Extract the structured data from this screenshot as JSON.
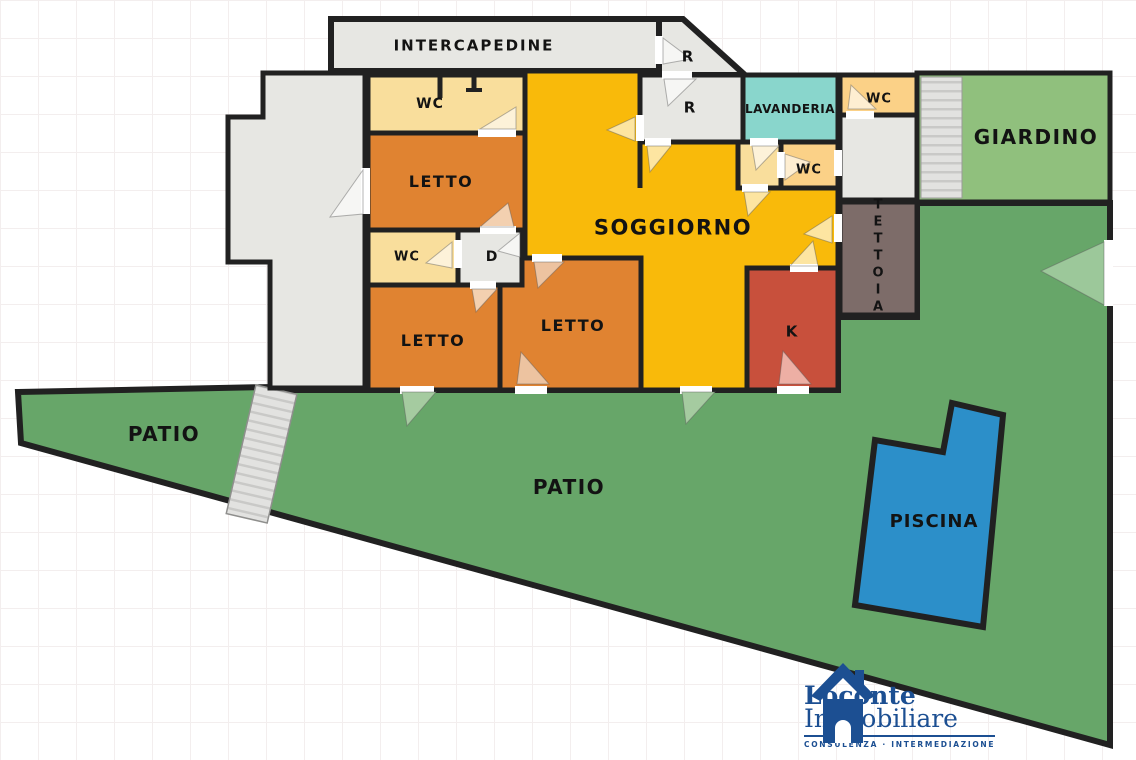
{
  "rooms": {
    "intercapedine": "INTERCAPEDINE",
    "r_top": "R",
    "r_mid": "R",
    "lavanderia": "LAVANDERIA",
    "wc_top_right": "WC",
    "giardino": "GIARDINO",
    "wc_top_left": "WC",
    "letto_1": "LETTO",
    "soggiorno": "SOGGIORNO",
    "wc_mid": "WC",
    "tettoia": "TETTOIA",
    "wc_small": "WC",
    "d": "D",
    "letto_2": "LETTO",
    "letto_3": "LETTO",
    "k": "K",
    "patio_left": "PATIO",
    "patio_main": "PATIO",
    "piscina": "PISCINA"
  },
  "colors": {
    "wall": "#212121",
    "room_gray": "#E7E7E3",
    "cream": "#F9DE9C",
    "light_orange": "#FBD187",
    "orange": "#E08331",
    "yellow": "#F9BA0A",
    "red": "#C8503C",
    "teal": "#89D6CC",
    "brown": "#7D6C69",
    "garden_green": "#90C07D",
    "patio_green": "#67A669",
    "pool_blue": "#2C8FC9",
    "logo_navy": "#1C4F92"
  },
  "logo": {
    "line1": "Loconte",
    "line2": "Immobiliare",
    "tagline": "CONSULENZA · INTERMEDIAZIONE"
  }
}
